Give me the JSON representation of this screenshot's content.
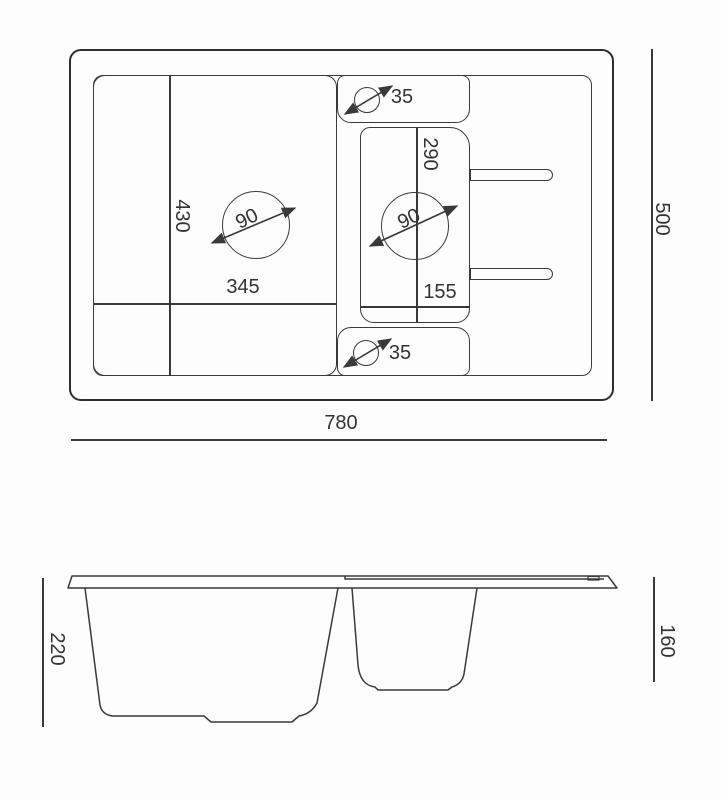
{
  "plan_view": {
    "overall_width": "780",
    "overall_depth": "500",
    "main_bowl": {
      "width": "345",
      "depth": "430",
      "drain_diameter": "90"
    },
    "small_bowl": {
      "width": "155",
      "depth": "290",
      "drain_diameter": "90"
    },
    "tap_hole_top_diameter": "35",
    "tap_hole_bottom_diameter": "35"
  },
  "side_view": {
    "main_bowl_depth": "220",
    "small_bowl_depth": "160"
  },
  "colors": {
    "line": "#3a3a3a",
    "outer_line": "#2e2e2e",
    "background": "#ffffff",
    "text": "#333333"
  }
}
